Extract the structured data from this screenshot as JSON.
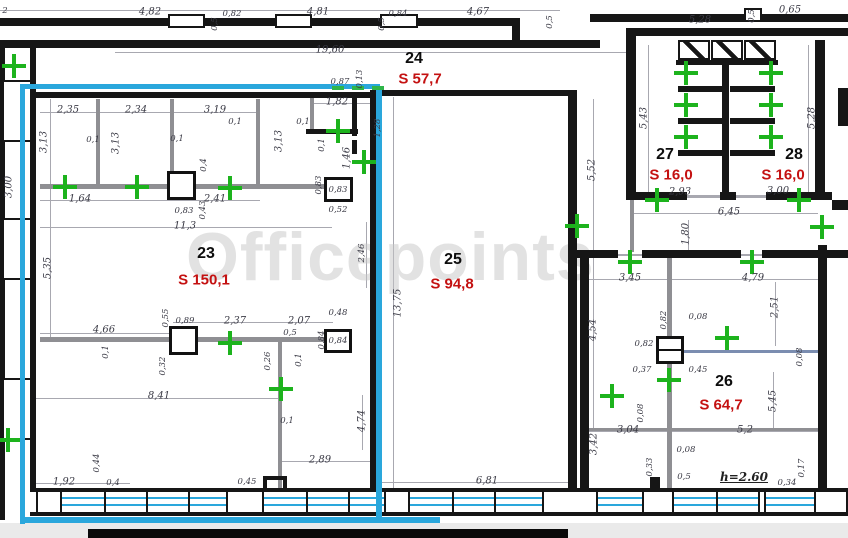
{
  "watermark": {
    "text": "Officepoints"
  },
  "colors": {
    "wall": "#161616",
    "partition": "#8f8f93",
    "highlight_cyan": "#2aa7dc",
    "cross_green": "#1db31d",
    "room_number": "#0d0d0d",
    "room_area_red": "#c41111",
    "dimension_text": "#3b3b46",
    "watermark_gray": "#c7c7c7"
  },
  "rooms": [
    {
      "number": "23",
      "area": "S 150,1",
      "nx": 206,
      "ny": 254,
      "ax": 204,
      "ay": 280
    },
    {
      "number": "24",
      "area": "S 57,7",
      "nx": 414,
      "ny": 59,
      "ax": 420,
      "ay": 79
    },
    {
      "number": "25",
      "area": "S 94,8",
      "nx": 453,
      "ny": 260,
      "ax": 452,
      "ay": 284
    },
    {
      "number": "26",
      "area": "S 64,7",
      "nx": 724,
      "ny": 382,
      "ax": 721,
      "ay": 405
    },
    {
      "number": "27",
      "area": "S 16,0",
      "nx": 665,
      "ny": 155,
      "ax": 671,
      "ay": 175
    },
    {
      "number": "28",
      "area": "S 16,0",
      "nx": 794,
      "ny": 155,
      "ax": 783,
      "ay": 175
    }
  ],
  "dims": [
    {
      "t": "2",
      "x": 5,
      "y": 11,
      "s": 1
    },
    {
      "t": "4,82",
      "x": 150,
      "y": 12
    },
    {
      "t": "0,82",
      "x": 232,
      "y": 14,
      "s": 1
    },
    {
      "t": "4,81",
      "x": 318,
      "y": 12
    },
    {
      "t": "0,84",
      "x": 398,
      "y": 14,
      "s": 1
    },
    {
      "t": "4,67",
      "x": 478,
      "y": 12
    },
    {
      "t": "0,5",
      "x": 215,
      "y": 24,
      "r": 1,
      "s": 1
    },
    {
      "t": "0,5",
      "x": 382,
      "y": 24,
      "r": 1,
      "s": 1
    },
    {
      "t": "0,5",
      "x": 550,
      "y": 22,
      "r": 1,
      "s": 1
    },
    {
      "t": "5,28",
      "x": 700,
      "y": 20
    },
    {
      "t": "0,5",
      "x": 752,
      "y": 16,
      "r": 1,
      "s": 1
    },
    {
      "t": "0,65",
      "x": 790,
      "y": 10
    },
    {
      "t": "19,60",
      "x": 330,
      "y": 50
    },
    {
      "t": "2,35",
      "x": 68,
      "y": 110
    },
    {
      "t": "2,34",
      "x": 136,
      "y": 110
    },
    {
      "t": "3,19",
      "x": 215,
      "y": 110
    },
    {
      "t": "3,13",
      "x": 44,
      "y": 142,
      "r": 1
    },
    {
      "t": "3,13",
      "x": 116,
      "y": 143,
      "r": 1
    },
    {
      "t": "3,13",
      "x": 279,
      "y": 141,
      "r": 1
    },
    {
      "t": "0,1",
      "x": 93,
      "y": 140,
      "s": 1
    },
    {
      "t": "0,1",
      "x": 177,
      "y": 139,
      "s": 1
    },
    {
      "t": "0,1",
      "x": 235,
      "y": 122,
      "s": 1
    },
    {
      "t": "0,1",
      "x": 303,
      "y": 122,
      "s": 1
    },
    {
      "t": "0,4",
      "x": 204,
      "y": 165,
      "r": 1,
      "s": 1
    },
    {
      "t": "1,64",
      "x": 80,
      "y": 199
    },
    {
      "t": "2,41",
      "x": 215,
      "y": 199
    },
    {
      "t": "0,83",
      "x": 184,
      "y": 211,
      "s": 1
    },
    {
      "t": "0,43",
      "x": 203,
      "y": 210,
      "r": 1,
      "s": 1
    },
    {
      "t": "11,3",
      "x": 185,
      "y": 226
    },
    {
      "t": "5,35",
      "x": 48,
      "y": 268,
      "r": 1
    },
    {
      "t": "0,87",
      "x": 340,
      "y": 82,
      "s": 1
    },
    {
      "t": "0,13",
      "x": 360,
      "y": 79,
      "r": 1,
      "s": 1
    },
    {
      "t": "1,82",
      "x": 337,
      "y": 102
    },
    {
      "t": "1,28",
      "x": 378,
      "y": 128,
      "r": 1,
      "s": 1
    },
    {
      "t": "0,1",
      "x": 322,
      "y": 145,
      "r": 1,
      "s": 1
    },
    {
      "t": "1,46",
      "x": 347,
      "y": 158,
      "r": 1
    },
    {
      "t": "0,83",
      "x": 319,
      "y": 185,
      "r": 1,
      "s": 1
    },
    {
      "t": "0,83",
      "x": 338,
      "y": 190,
      "s": 1
    },
    {
      "t": "0,52",
      "x": 338,
      "y": 210,
      "s": 1
    },
    {
      "t": "0,55",
      "x": 166,
      "y": 318,
      "r": 1,
      "s": 1
    },
    {
      "t": "0,89",
      "x": 185,
      "y": 321,
      "s": 1
    },
    {
      "t": "2,37",
      "x": 235,
      "y": 321
    },
    {
      "t": "2,07",
      "x": 299,
      "y": 321
    },
    {
      "t": "0,5",
      "x": 290,
      "y": 333,
      "s": 1
    },
    {
      "t": "0,48",
      "x": 338,
      "y": 313,
      "s": 1
    },
    {
      "t": "0,84",
      "x": 322,
      "y": 340,
      "r": 1,
      "s": 1
    },
    {
      "t": "0,84",
      "x": 338,
      "y": 341,
      "s": 1
    },
    {
      "t": "4,66",
      "x": 104,
      "y": 330
    },
    {
      "t": "0,1",
      "x": 106,
      "y": 352,
      "r": 1,
      "s": 1
    },
    {
      "t": "0,26",
      "x": 268,
      "y": 361,
      "r": 1,
      "s": 1
    },
    {
      "t": "0,1",
      "x": 299,
      "y": 360,
      "r": 1,
      "s": 1
    },
    {
      "t": "0,32",
      "x": 163,
      "y": 366,
      "r": 1,
      "s": 1
    },
    {
      "t": "8,41",
      "x": 159,
      "y": 396
    },
    {
      "t": "0,1",
      "x": 287,
      "y": 421,
      "s": 1
    },
    {
      "t": "4,74",
      "x": 362,
      "y": 421,
      "r": 1
    },
    {
      "t": "13,75",
      "x": 398,
      "y": 303,
      "r": 1
    },
    {
      "t": "2,46",
      "x": 362,
      "y": 253,
      "r": 1,
      "s": 1
    },
    {
      "t": "2,89",
      "x": 320,
      "y": 460
    },
    {
      "t": "0,45",
      "x": 247,
      "y": 482,
      "s": 1
    },
    {
      "t": "1,92",
      "x": 64,
      "y": 482
    },
    {
      "t": "0,4",
      "x": 113,
      "y": 483,
      "s": 1
    },
    {
      "t": "0,44",
      "x": 97,
      "y": 463,
      "r": 1,
      "s": 1
    },
    {
      "t": "6,81",
      "x": 487,
      "y": 481
    },
    {
      "t": "5,52",
      "x": 592,
      "y": 170,
      "r": 1
    },
    {
      "t": "4,54",
      "x": 593,
      "y": 330,
      "r": 1
    },
    {
      "t": "5,43",
      "x": 644,
      "y": 118,
      "r": 1
    },
    {
      "t": "5,28",
      "x": 812,
      "y": 118,
      "r": 1
    },
    {
      "t": "2,93",
      "x": 680,
      "y": 192
    },
    {
      "t": "3,00",
      "x": 778,
      "y": 191
    },
    {
      "t": "6,45",
      "x": 729,
      "y": 212
    },
    {
      "t": "1,80",
      "x": 686,
      "y": 234,
      "r": 1
    },
    {
      "t": "3,45",
      "x": 630,
      "y": 278
    },
    {
      "t": "4,79",
      "x": 753,
      "y": 278
    },
    {
      "t": "2,51",
      "x": 775,
      "y": 307,
      "r": 1
    },
    {
      "t": "0,82",
      "x": 664,
      "y": 320,
      "r": 1,
      "s": 1
    },
    {
      "t": "0,08",
      "x": 698,
      "y": 317,
      "s": 1
    },
    {
      "t": "0,82",
      "x": 644,
      "y": 344,
      "s": 1
    },
    {
      "t": "0,37",
      "x": 642,
      "y": 370,
      "s": 1
    },
    {
      "t": "0,45",
      "x": 698,
      "y": 370,
      "s": 1
    },
    {
      "t": "0,08",
      "x": 800,
      "y": 357,
      "r": 1,
      "s": 1
    },
    {
      "t": "5,45",
      "x": 773,
      "y": 401,
      "r": 1
    },
    {
      "t": "3,04",
      "x": 628,
      "y": 430
    },
    {
      "t": "0,08",
      "x": 641,
      "y": 413,
      "r": 1,
      "s": 1
    },
    {
      "t": "5,2",
      "x": 745,
      "y": 430
    },
    {
      "t": "3,42",
      "x": 594,
      "y": 444,
      "r": 1
    },
    {
      "t": "0,33",
      "x": 650,
      "y": 467,
      "r": 1,
      "s": 1
    },
    {
      "t": "0,08",
      "x": 686,
      "y": 450,
      "s": 1
    },
    {
      "t": "0,5",
      "x": 684,
      "y": 477,
      "s": 1
    },
    {
      "t": "0,34",
      "x": 787,
      "y": 483,
      "s": 1
    },
    {
      "t": "0,17",
      "x": 802,
      "y": 468,
      "r": 1,
      "s": 1
    },
    {
      "t": "3,00",
      "x": 9,
      "y": 187,
      "r": 1
    },
    {
      "t": "h=2.60",
      "x": 744,
      "y": 477,
      "u": 1
    }
  ],
  "geometry": {
    "gray_strips": [
      [
        0,
        523,
        848,
        15
      ]
    ],
    "dimlines": [
      [
        0,
        10,
        560,
        1
      ],
      [
        115,
        52,
        513,
        1
      ],
      [
        40,
        112,
        220,
        1
      ],
      [
        40,
        200,
        220,
        1
      ],
      [
        40,
        227,
        292,
        1
      ],
      [
        50,
        99,
        1,
        238
      ],
      [
        310,
        103,
        62,
        1
      ],
      [
        393,
        97,
        1,
        391
      ],
      [
        173,
        322,
        160,
        1
      ],
      [
        40,
        333,
        132,
        1
      ],
      [
        36,
        398,
        244,
        1
      ],
      [
        282,
        461,
        93,
        1
      ],
      [
        36,
        483,
        94,
        1
      ],
      [
        380,
        482,
        188,
        1
      ],
      [
        593,
        99,
        1,
        153
      ],
      [
        593,
        258,
        1,
        172
      ],
      [
        648,
        45,
        1,
        147
      ],
      [
        808,
        45,
        1,
        147
      ],
      [
        648,
        195,
        160,
        1
      ],
      [
        632,
        213,
        186,
        1
      ],
      [
        688,
        220,
        1,
        32
      ],
      [
        589,
        279,
        229,
        1
      ],
      [
        775,
        282,
        1,
        64
      ],
      [
        773,
        372,
        1,
        56
      ],
      [
        589,
        431,
        229,
        1
      ],
      [
        362,
        395,
        1,
        55
      ],
      [
        366,
        222,
        1,
        66
      ],
      [
        687,
        196,
        33,
        2
      ],
      [
        736,
        196,
        30,
        2
      ],
      [
        618,
        254,
        24,
        2
      ],
      [
        741,
        254,
        21,
        2
      ]
    ],
    "partitions": [
      [
        40,
        184,
        292,
        5
      ],
      [
        96,
        99,
        4,
        86
      ],
      [
        170,
        99,
        4,
        73
      ],
      [
        256,
        99,
        4,
        86
      ],
      [
        310,
        95,
        4,
        36
      ],
      [
        40,
        337,
        292,
        5
      ],
      [
        278,
        342,
        4,
        146
      ],
      [
        667,
        258,
        5,
        232
      ],
      [
        589,
        428,
        230,
        3
      ],
      [
        630,
        200,
        4,
        52
      ]
    ],
    "accent_partitions": [
      [
        672,
        350,
        147,
        3
      ]
    ],
    "walls": [
      [
        0,
        40,
        600,
        8
      ],
      [
        632,
        28,
        216,
        8
      ],
      [
        626,
        28,
        10,
        172
      ],
      [
        815,
        40,
        10,
        160
      ],
      [
        838,
        88,
        10,
        38
      ],
      [
        832,
        200,
        16,
        10
      ],
      [
        0,
        40,
        5,
        480
      ],
      [
        30,
        40,
        6,
        452
      ],
      [
        36,
        92,
        342,
        6
      ],
      [
        370,
        92,
        9,
        398
      ],
      [
        568,
        92,
        9,
        398
      ],
      [
        370,
        90,
        207,
        6
      ],
      [
        722,
        60,
        7,
        134
      ],
      [
        632,
        192,
        55,
        8
      ],
      [
        720,
        192,
        16,
        8
      ],
      [
        766,
        192,
        66,
        8
      ],
      [
        676,
        60,
        102,
        5
      ],
      [
        576,
        250,
        42,
        8
      ],
      [
        642,
        250,
        99,
        8
      ],
      [
        762,
        250,
        86,
        8
      ],
      [
        580,
        256,
        9,
        236
      ],
      [
        818,
        245,
        9,
        247
      ],
      [
        306,
        129,
        52,
        5
      ],
      [
        352,
        96,
        5,
        40
      ],
      [
        352,
        140,
        5,
        14
      ],
      [
        650,
        477,
        10,
        15
      ],
      [
        263,
        476,
        24,
        4
      ],
      [
        263,
        476,
        4,
        14
      ],
      [
        283,
        476,
        4,
        14
      ],
      [
        0,
        18,
        168,
        8
      ],
      [
        205,
        18,
        70,
        8
      ],
      [
        312,
        18,
        68,
        8
      ],
      [
        418,
        18,
        100,
        8
      ],
      [
        512,
        18,
        8,
        26
      ],
      [
        590,
        14,
        154,
        8
      ],
      [
        760,
        14,
        88,
        8
      ],
      [
        36,
        488,
        812,
        4
      ],
      [
        30,
        512,
        818,
        4
      ]
    ],
    "hollows": [
      [
        168,
        14,
        37,
        14
      ],
      [
        275,
        14,
        37,
        14
      ],
      [
        380,
        14,
        38,
        14
      ],
      [
        744,
        8,
        18,
        14
      ],
      [
        2,
        80,
        30,
        62
      ],
      [
        2,
        218,
        30,
        62
      ],
      [
        2,
        378,
        30,
        62
      ]
    ],
    "hatches": [
      [
        678,
        40,
        32,
        20
      ],
      [
        711,
        40,
        32,
        20
      ],
      [
        744,
        40,
        32,
        20
      ]
    ],
    "stall_partitions": [
      [
        678,
        86,
        45,
        6
      ],
      [
        678,
        118,
        45,
        6
      ],
      [
        678,
        150,
        45,
        6
      ],
      [
        730,
        86,
        45,
        6
      ],
      [
        730,
        118,
        45,
        6
      ],
      [
        730,
        150,
        45,
        6
      ]
    ],
    "columns": [
      {
        "x": 167,
        "y": 171,
        "w": 29,
        "h": 29,
        "mid": false
      },
      {
        "x": 324,
        "y": 177,
        "w": 29,
        "h": 25,
        "mid": false
      },
      {
        "x": 169,
        "y": 326,
        "w": 29,
        "h": 29,
        "mid": false
      },
      {
        "x": 324,
        "y": 329,
        "w": 28,
        "h": 24,
        "mid": false
      },
      {
        "x": 656,
        "y": 336,
        "w": 28,
        "h": 28,
        "mid": true
      }
    ],
    "window_band": {
      "glazing_rows": [
        497,
        504
      ],
      "glazing": [
        [
          62,
          226
        ],
        [
          264,
          384
        ],
        [
          410,
          542
        ],
        [
          598,
          642
        ],
        [
          674,
          758
        ],
        [
          766,
          814
        ]
      ],
      "piers": [
        [
          36,
          26
        ],
        [
          226,
          38
        ],
        [
          384,
          26
        ],
        [
          542,
          56
        ],
        [
          642,
          32
        ],
        [
          758,
          8
        ],
        [
          814,
          34
        ]
      ],
      "mullions": [
        104,
        146,
        188,
        306,
        348,
        452,
        494,
        716
      ]
    },
    "highlight": [
      [
        20,
        84,
        360,
        5
      ],
      [
        20,
        84,
        5,
        440
      ],
      [
        376,
        88,
        6,
        432
      ],
      [
        20,
        517,
        420,
        6
      ]
    ],
    "green_dashes": [
      [
        332,
        86,
        12,
        4
      ],
      [
        352,
        86,
        12,
        4
      ],
      [
        372,
        86,
        12,
        4
      ]
    ],
    "crosses": [
      [
        14,
        66
      ],
      [
        65,
        187
      ],
      [
        137,
        187
      ],
      [
        230,
        188
      ],
      [
        338,
        131
      ],
      [
        364,
        162
      ],
      [
        230,
        343
      ],
      [
        281,
        389
      ],
      [
        8,
        440
      ],
      [
        577,
        226
      ],
      [
        686,
        73
      ],
      [
        771,
        73
      ],
      [
        686,
        105
      ],
      [
        771,
        105
      ],
      [
        686,
        137
      ],
      [
        771,
        137
      ],
      [
        657,
        200
      ],
      [
        799,
        200
      ],
      [
        630,
        262
      ],
      [
        752,
        262
      ],
      [
        822,
        227
      ],
      [
        727,
        338
      ],
      [
        669,
        380
      ],
      [
        612,
        396
      ]
    ],
    "bottom_bar": [
      88,
      529,
      480,
      9
    ]
  }
}
